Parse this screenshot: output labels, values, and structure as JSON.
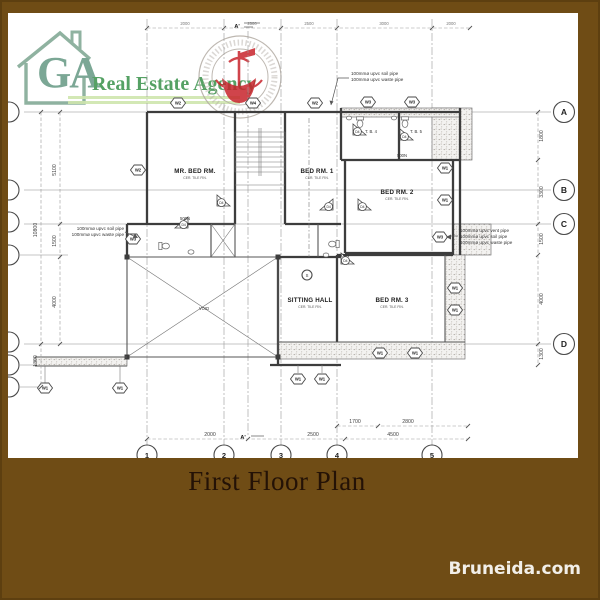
{
  "logo": {
    "monogram": "GA",
    "name": "Real Estate Agency",
    "house_color": "#8fb2a0",
    "text_color": "#55a164",
    "underline_color": "#cfe6ae"
  },
  "stamp": {
    "emblem_color": "#c8242c",
    "ring_color": "#b3aca4"
  },
  "caption": {
    "title": "First Floor Plan"
  },
  "watermark": {
    "label": "Bruneida.com"
  },
  "palette": {
    "background": "#6f4c15",
    "sheet": "#ffffff",
    "ink": "#3d3d3d"
  },
  "plan": {
    "rooms": {
      "master": {
        "label": "MR. BED RM.",
        "finish": "CER. TILE FIN."
      },
      "bed1": {
        "label": "BED RM. 1",
        "finish": "CER. TILE FIN."
      },
      "bed2": {
        "label": "BED RM. 2",
        "finish": "CER. TILE FIN."
      },
      "bed3": {
        "label": "BED RM. 3",
        "finish": "CER. TILE FIN."
      },
      "sitting": {
        "label": "SITTING HALL",
        "finish": "CER. TILE FIN."
      },
      "tb4": {
        "label": "T. B. 4"
      },
      "tb5": {
        "label": "T. B. 5"
      },
      "void": {
        "label": "VOID"
      }
    },
    "notes": {
      "top": [
        "100mmø upvc soil pipe",
        "100mmø upvc waste pipe"
      ],
      "right": [
        "100mmø upvc vent pipe",
        "100mmø upvc soil pipe",
        "100mmø upvc waste pipe"
      ],
      "left": [
        "100mmø upvc soil pipe",
        "100mmø upvc waste pipe"
      ]
    },
    "grid": {
      "letters": [
        "A",
        "B",
        "C",
        "D"
      ],
      "numbers": [
        "1",
        "2",
        "3",
        "4",
        "5"
      ]
    },
    "dims": {
      "left_inner": [
        "5100",
        "1500",
        "4000"
      ],
      "left_outer": [
        "10800",
        "1300"
      ],
      "right": [
        "1800",
        "3300",
        "1500",
        "4000",
        "1300"
      ],
      "bottom": [
        "2000",
        "2500",
        "4500"
      ],
      "bottom_upper": [
        "1700",
        "2800"
      ],
      "top": [
        "2000",
        "2500",
        "2500",
        "3000",
        "2000"
      ]
    },
    "markers": {
      "w1": "W1",
      "w2": "W2",
      "w3": "W3",
      "w4": "W4",
      "d4": "D4",
      "s": "S",
      "section": "A'",
      "label_500n": "500N"
    }
  }
}
